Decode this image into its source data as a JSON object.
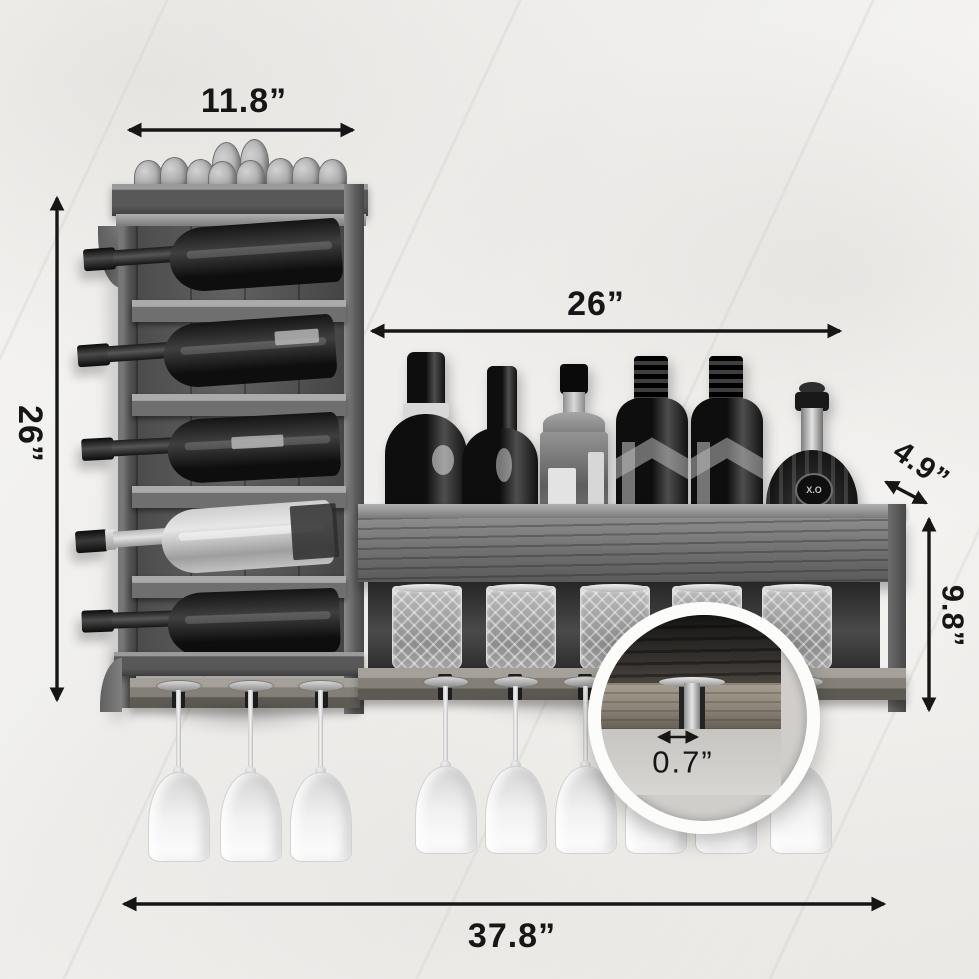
{
  "image": {
    "type": "product-dimension-photo",
    "subject": "Wall-mounted wooden wine rack with bottle shelf, tumbler cubby and hanging stemware, black-and-white photo on marble wall",
    "colors": {
      "annotation": "#161616",
      "background": "#f2f1ee",
      "magnifier_ring": "#fcfcfb"
    }
  },
  "dimensions": {
    "top_width": "11.8”",
    "left_height": "26”",
    "shelf_width": "26”",
    "shelf_depth": "4.9”",
    "shelf_height": "9.8”",
    "slot_width": "0.7”",
    "total_width": "37.8”"
  },
  "product": {
    "xo_label": "X.O",
    "counts": {
      "corks_on_top": 10,
      "wine_bottles_left_rack": 5,
      "liquor_bottles_on_shelf": 6,
      "crystal_tumblers": 5,
      "hanging_glasses_left": 3,
      "hanging_glasses_right": 6
    }
  }
}
